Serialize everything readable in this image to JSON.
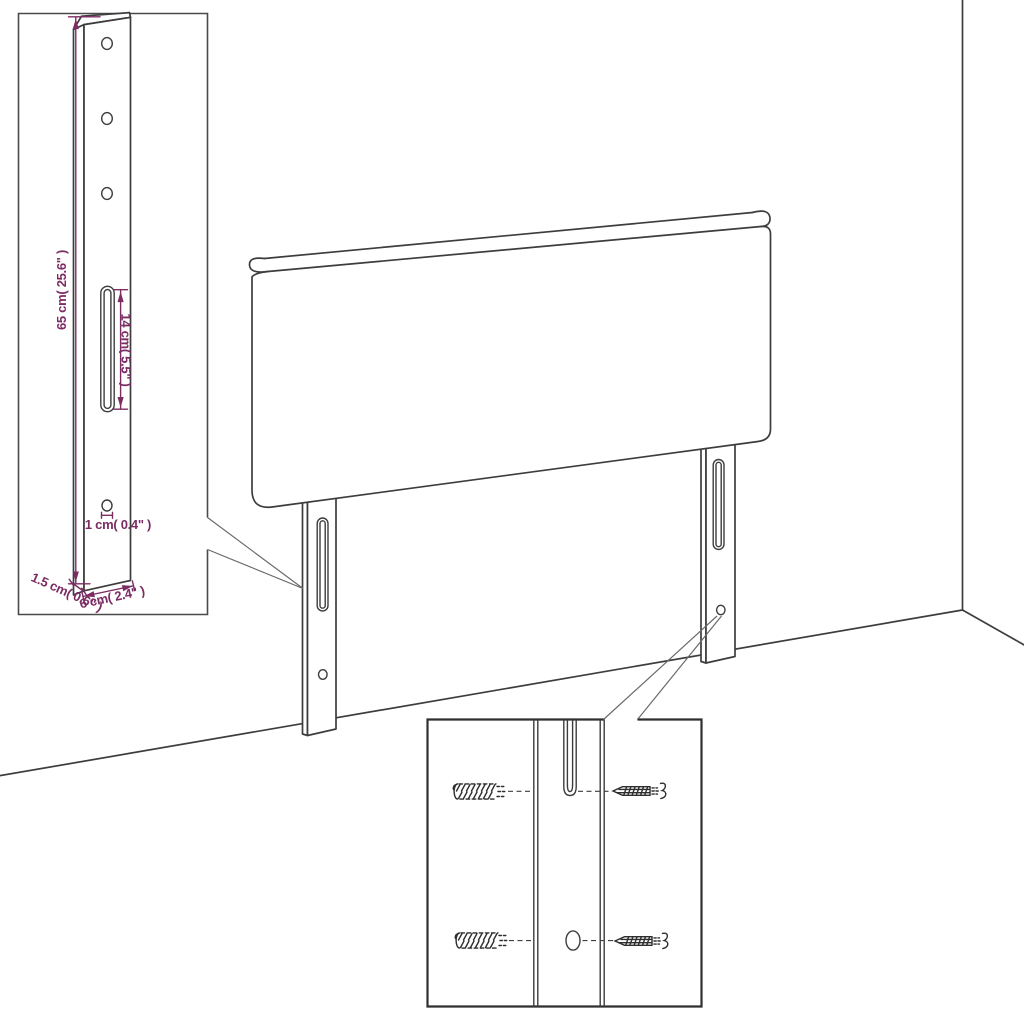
{
  "diagram": {
    "subject": "upholstered headboard with two mounting legs, wall and floor corner, detail insets",
    "colors": {
      "line": "#3d3d3d",
      "dimension": "#7b2c63",
      "background": "#ffffff"
    },
    "hardware_inset": {
      "parts": [
        "wall-plug",
        "screw",
        "keyhole-slot",
        "screw-hole"
      ]
    }
  },
  "dims": {
    "height": "65 cm( 25.6\" )",
    "slot": "14 cm( 5.5\" )",
    "hole": "1 cm( 0.4\" )",
    "depth": "1.5 cm( 0.6\" )",
    "width": "6 cm( 2.4\" )"
  }
}
